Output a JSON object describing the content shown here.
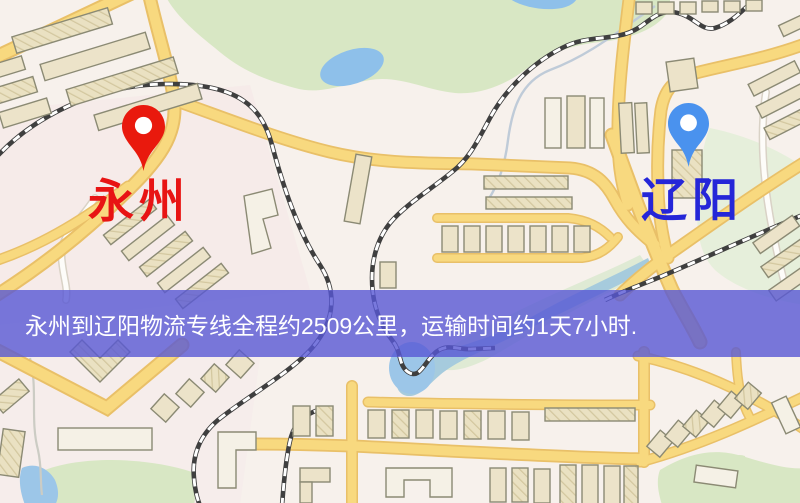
{
  "page": {
    "width": 800,
    "height": 503,
    "kind": "logistics-route-map"
  },
  "map": {
    "origin": {
      "name": "永州",
      "pin": "red-pin",
      "pin_color": "#e9190d",
      "label_color": "#e81414"
    },
    "destination": {
      "name": "辽阳",
      "pin": "blue-pin",
      "pin_color": "#4a92ee",
      "label_color": "#2526d8"
    },
    "banner": {
      "text": "永州到辽阳物流专线全程约2509公里，运输时间约1天7小时.",
      "distance_km": 2509,
      "duration": "1天7小时",
      "background_color": "#5858d5",
      "text_color": "#ffffff"
    },
    "palette": {
      "map_background": "#f7f1ec",
      "road_fill": "#f8d97f",
      "road_casing": "#e9c068",
      "park_green": "#d8e7c4",
      "pale_green": "#e6efdb",
      "water_blue": "#9cc6e8",
      "railway_dark": "#3f3f3f",
      "building_fill": "#ece3c9"
    }
  }
}
